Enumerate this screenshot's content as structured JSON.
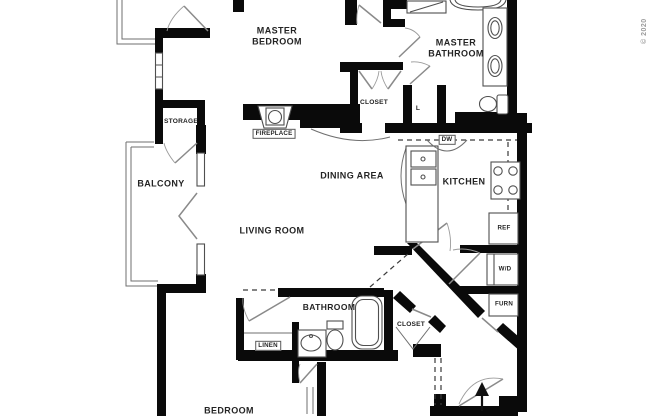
{
  "page": {
    "background": "#ffffff"
  },
  "watermark": {
    "text": "© 2020"
  },
  "colors": {
    "wall": "#0a0a0a",
    "line": "#4f4f4f",
    "door": "#8a8a8a",
    "label": "#242424",
    "watermark": "#9a9a9a",
    "background": "#ffffff"
  },
  "rooms": {
    "master_bedroom": "MASTER\nBEDROOM",
    "master_bathroom": "MASTER\nBATHROOM",
    "storage": "STORAGE",
    "balcony": "BALCONY",
    "dining_area": "DINING AREA",
    "kitchen": "KITCHEN",
    "living_room": "LIVING ROOM",
    "bathroom": "BATHROOM",
    "bedroom": "BEDROOM",
    "closet_master": "CLOSET",
    "closet_bedroom": "CLOSET",
    "linen_closet_small": "L",
    "linen": "LINEN"
  },
  "fixtures": {
    "fireplace": "FIREPLACE",
    "dishwasher": "DW",
    "refrigerator": "REF",
    "washer_dryer": "W/D",
    "furnace": "FURN"
  }
}
